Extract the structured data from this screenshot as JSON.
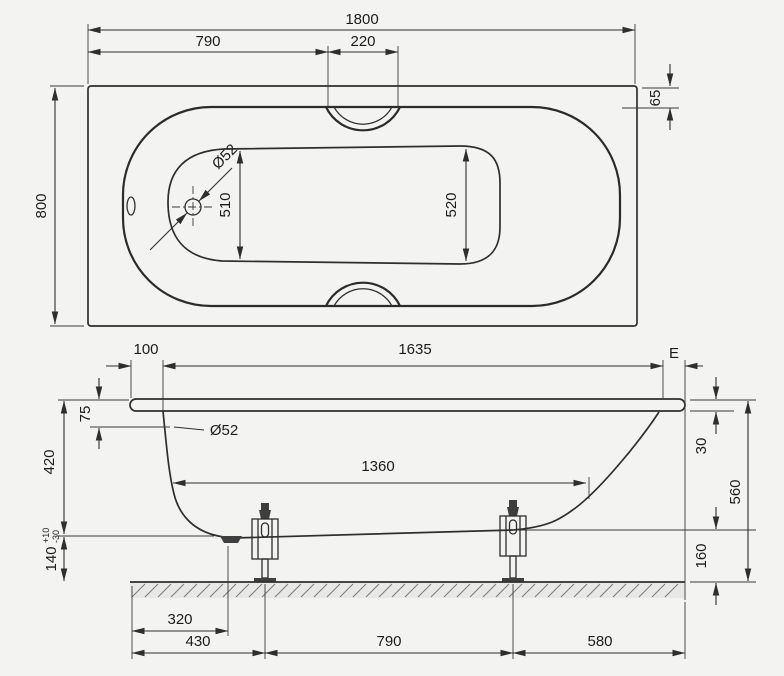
{
  "drawing": {
    "top_view": {
      "overall_length": "1800",
      "length_to_grip": "790",
      "grip_width": "220",
      "overall_width": "800",
      "rim_overhang": "65",
      "drain_diameter": "Ø52",
      "inner_width_drain_end": "510",
      "inner_width_head_end": "520"
    },
    "side_view": {
      "edge_offset": "100",
      "rim_length": "1635",
      "apron_label": "E",
      "overflow_depth": "75",
      "drain_diameter": "Ø52",
      "inner_depth": "420",
      "base_height": "140",
      "base_height_tol_plus": "+10",
      "base_height_tol_minus": "-30",
      "bottom_length": "1360",
      "rim_height": "30",
      "total_height": "560",
      "foot_clearance": "160",
      "drain_offset": "320",
      "foot1_offset": "430",
      "foot_spacing": "790",
      "foot2_to_end": "580"
    }
  }
}
